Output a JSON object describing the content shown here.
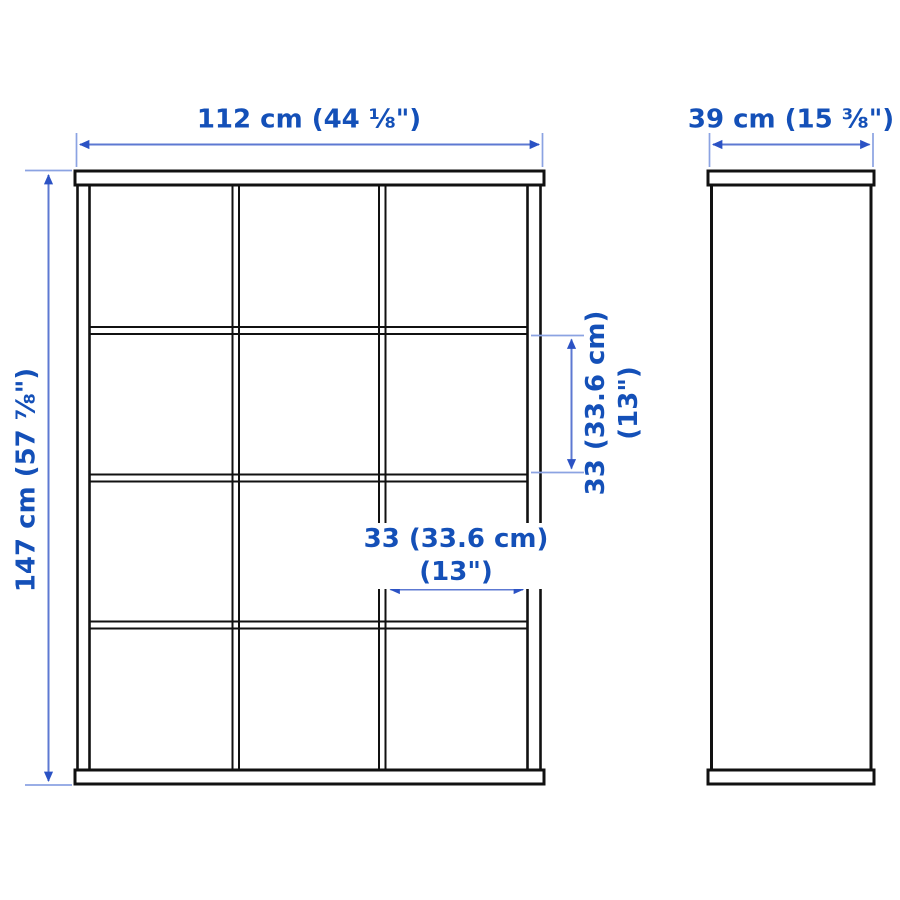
{
  "colors": {
    "page_bg": "#ffffff",
    "outline": "#111111",
    "text_blue": "#1450b8",
    "dim_line": "#5d79d2",
    "dim_tick": "#8ba3e2",
    "arrow": "#2b52c4"
  },
  "views": {
    "front": {
      "rows": 4,
      "columns": 3,
      "cube_count": 12
    },
    "side": {}
  },
  "dimensions": {
    "width": {
      "label": "112 cm (44 ⅛\")"
    },
    "depth": {
      "label": "39 cm (15 ⅜\")"
    },
    "height": {
      "label": "147 cm (57 ⅞\")"
    },
    "cube_height": {
      "line1": "33 (33.6 cm)",
      "line2": "(13\")"
    },
    "cube_width": {
      "line1": "33 (33.6 cm)",
      "line2": "(13\")"
    }
  }
}
